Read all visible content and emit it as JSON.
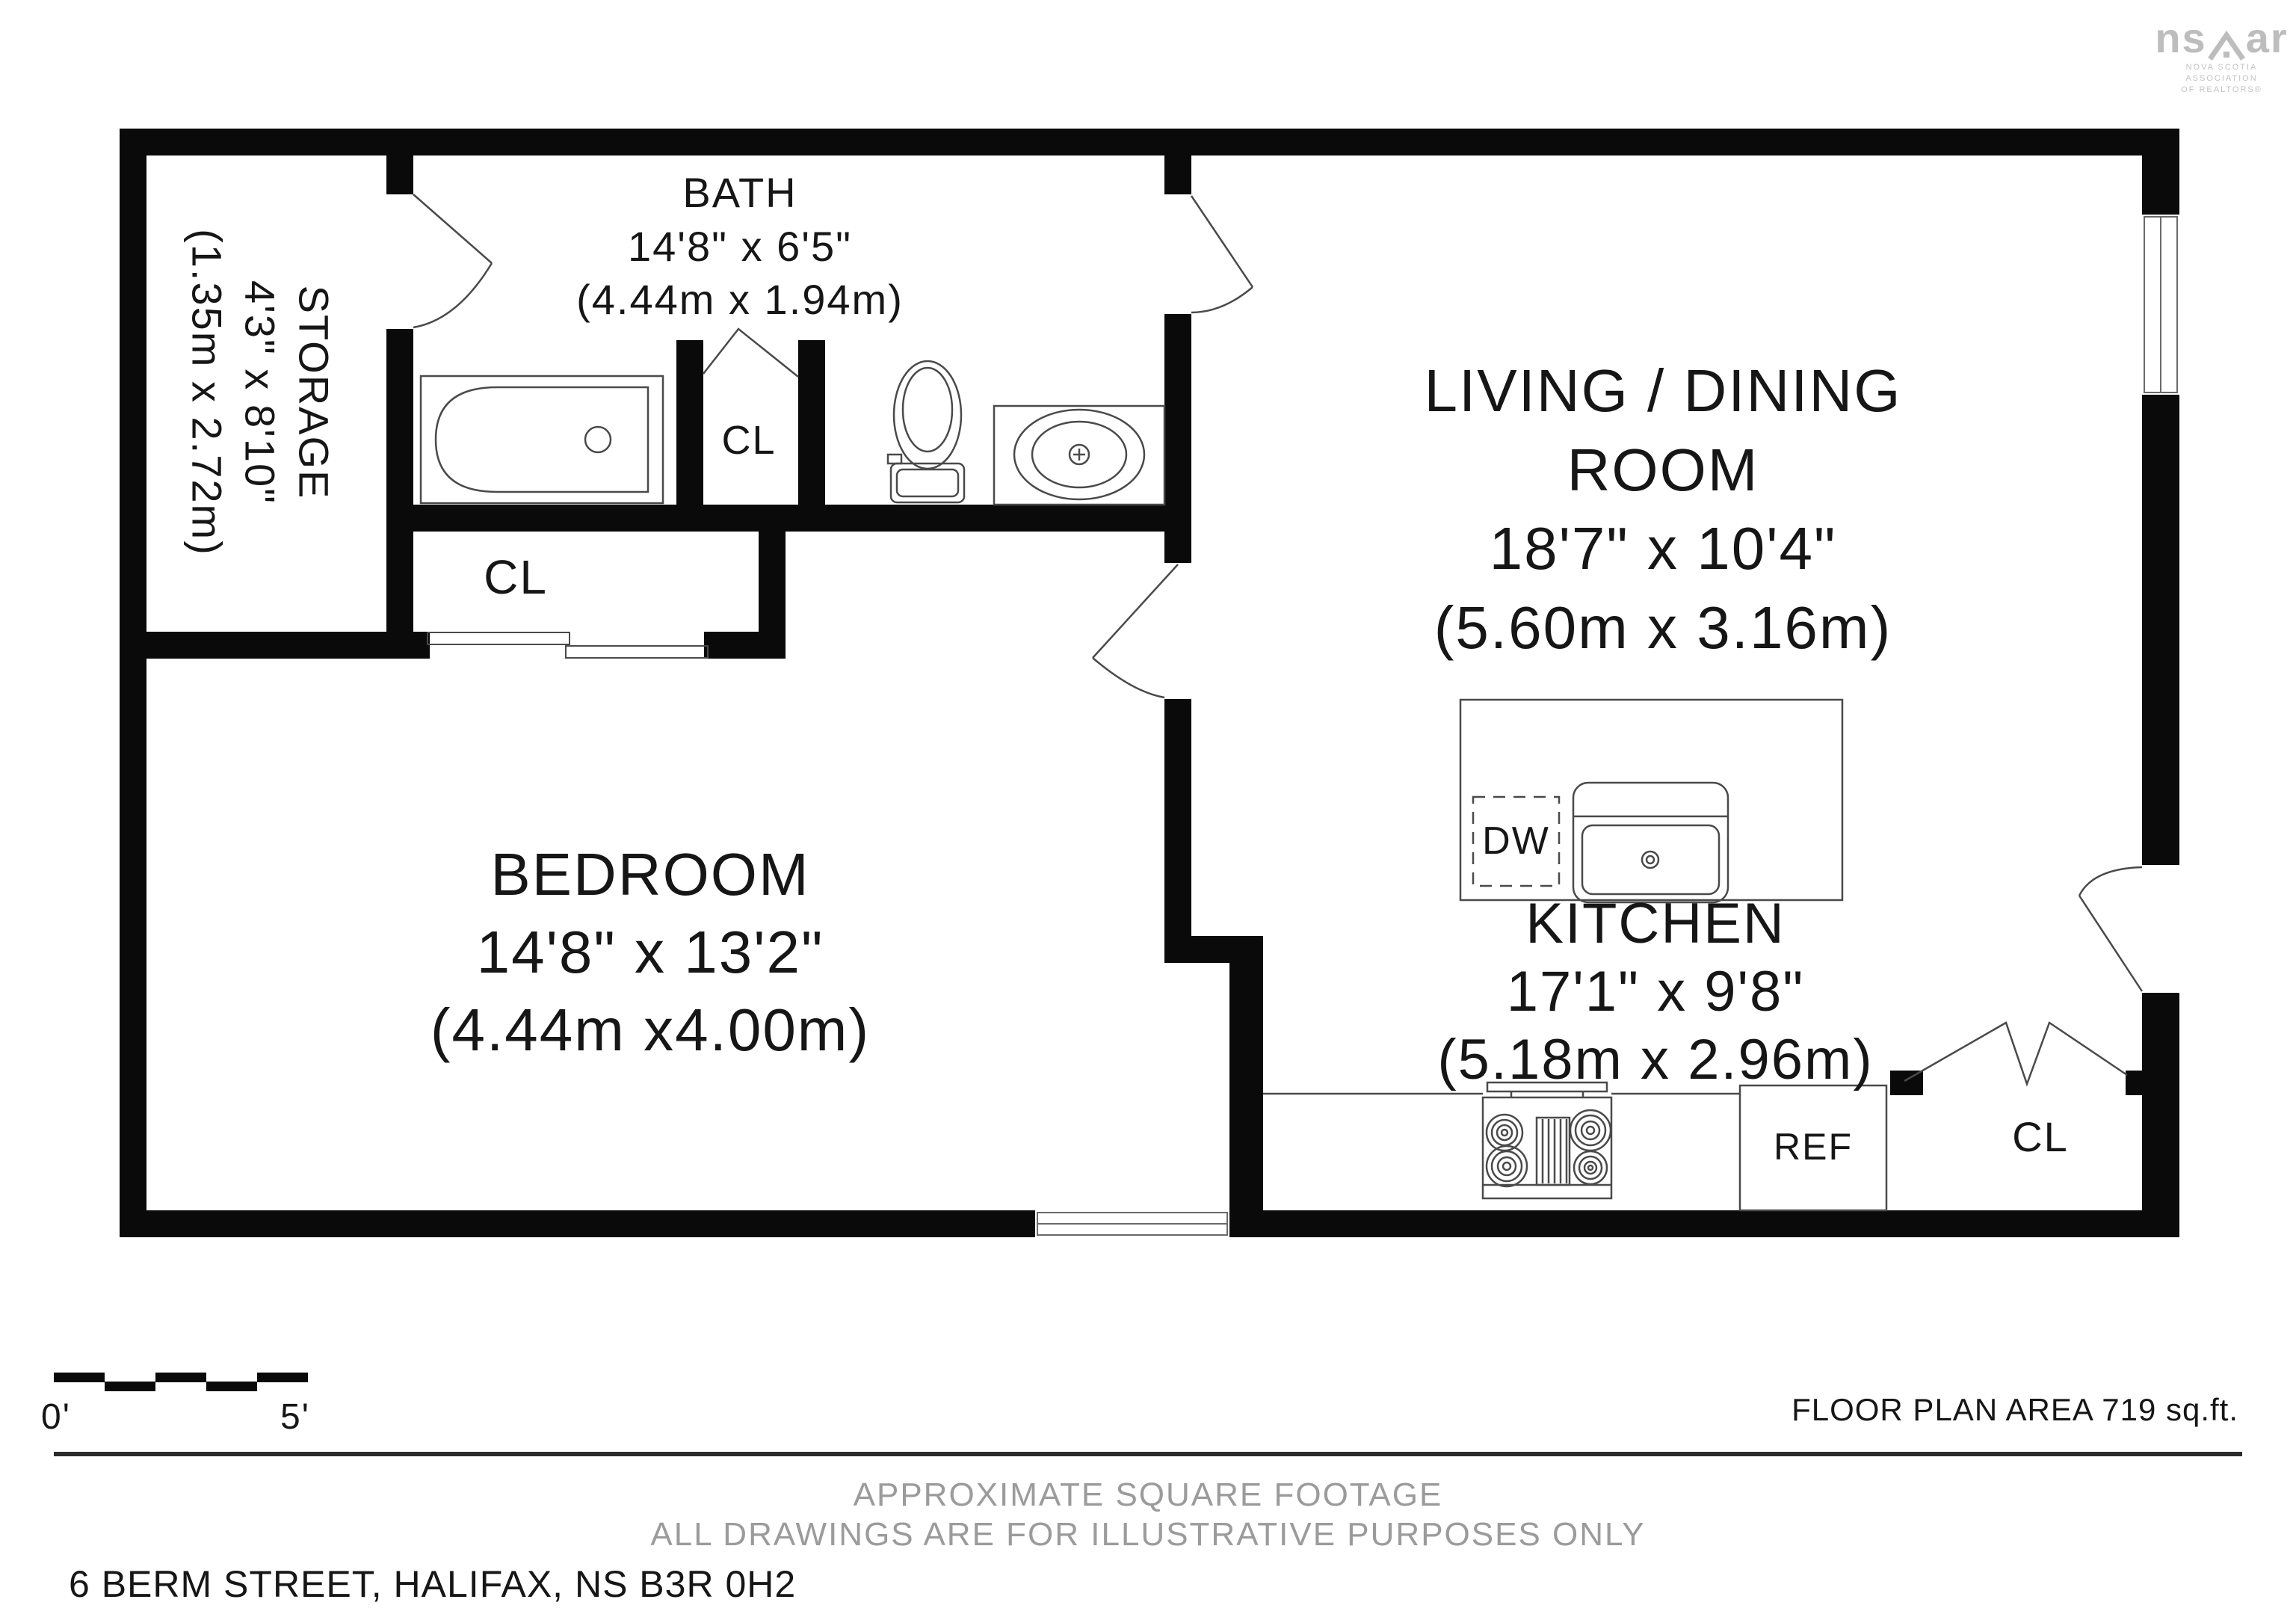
{
  "rooms": {
    "storage": {
      "name": "STORAGE",
      "imperial": "4'3\" x 8'10\"",
      "metric": "(1.35m x 2.72m)"
    },
    "bath": {
      "name": "BATH",
      "imperial": "14'8\" x 6'5\"",
      "metric": "(4.44m x 1.94m)"
    },
    "living": {
      "name": "LIVING / DINING",
      "name2": "ROOM",
      "imperial": "18'7\" x 10'4\"",
      "metric": "(5.60m x 3.16m)"
    },
    "bedroom": {
      "name": "BEDROOM",
      "imperial": "14'8\" x 13'2\"",
      "metric": "(4.44m x4.00m)"
    },
    "kitchen": {
      "name": "KITCHEN",
      "imperial": "17'1\" x 9'8\"",
      "metric": "(5.18m x 2.96m)"
    }
  },
  "fixtures": {
    "closet": "CL",
    "dishwasher": "DW",
    "refrigerator": "REF"
  },
  "scale_bar": {
    "start": "0'",
    "end": "5'"
  },
  "footer": {
    "area": "FLOOR PLAN AREA 719 sq.ft.",
    "line1": "APPROXIMATE SQUARE FOOTAGE",
    "line2": "ALL DRAWINGS ARE FOR ILLUSTRATIVE PURPOSES ONLY",
    "address": "6 BERM STREET, HALIFAX, NS B3R 0H2"
  },
  "logo": {
    "text_left": "ns",
    "text_right": "ar",
    "sub1": "NOVA SCOTIA ASSOCIATION",
    "sub2": "OF REALTORS®"
  },
  "colors": {
    "wall": "#0a0a0a",
    "thin_line": "#4a4a4a",
    "gray_text": "#9b9b9b",
    "logo_gray": "#bdbdbd"
  }
}
